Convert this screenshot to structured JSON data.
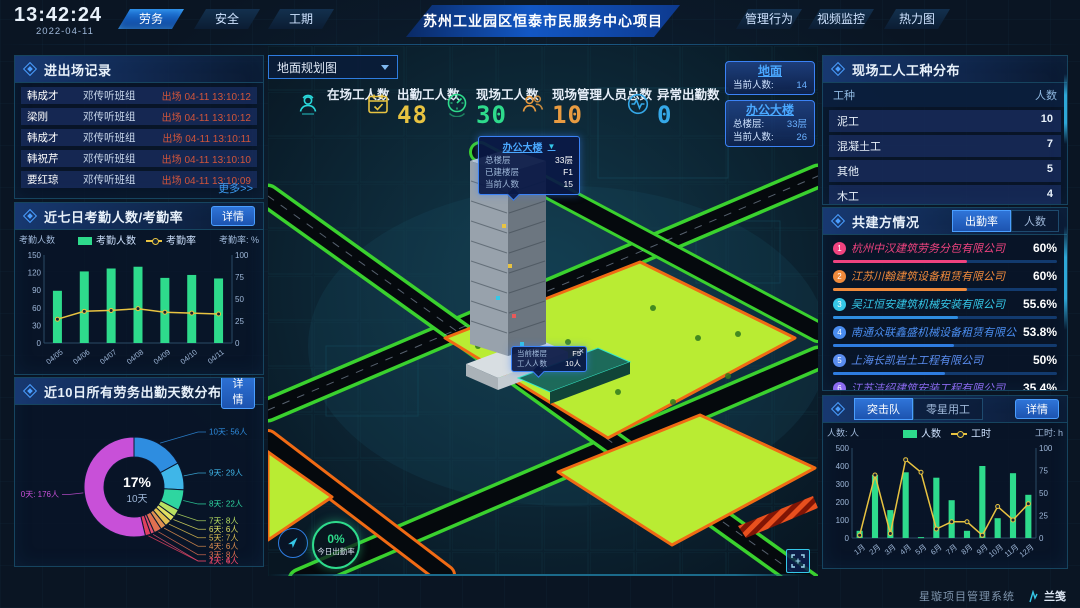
{
  "header": {
    "time": "13:42:24",
    "date": "2022-04-11",
    "left_tabs": [
      {
        "label": "劳务",
        "active": true
      },
      {
        "label": "安全",
        "active": false
      },
      {
        "label": "工期",
        "active": false
      }
    ],
    "title": "苏州工业园区恒泰市民服务中心项目",
    "right_tabs": [
      {
        "label": "管理行为",
        "active": false
      },
      {
        "label": "视频监控",
        "active": false
      },
      {
        "label": "热力图",
        "active": false
      }
    ]
  },
  "entry_exit": {
    "title": "进出场记录",
    "more_label": "更多>>",
    "rows": [
      {
        "name": "韩成才",
        "group": "邓传听班组",
        "event": "出场 04-11 13:10:12"
      },
      {
        "name": "梁刚",
        "group": "邓传听班组",
        "event": "出场 04-11 13:10:12"
      },
      {
        "name": "韩成才",
        "group": "邓传听班组",
        "event": "出场 04-11 13:10:11"
      },
      {
        "name": "韩祝芹",
        "group": "邓传听班组",
        "event": "出场 04-11 13:10:10"
      },
      {
        "name": "要红琼",
        "group": "邓传听班组",
        "event": "出场 04-11 13:10:09"
      }
    ]
  },
  "attendance7": {
    "title": "近七日考勤人数/考勤率",
    "detail_label": "详情"
  },
  "distribution10": {
    "title": "近10日所有劳务出勤天数分布",
    "detail_label": "详情"
  },
  "map": {
    "view_select": "地面规划图",
    "stats": [
      {
        "label": "在场工人数",
        "value": "",
        "color": "#29d8db",
        "icon": "worker-icon"
      },
      {
        "label": "出勤工人数",
        "value": "48",
        "color": "#e8c341",
        "icon": "calendar-check-icon"
      },
      {
        "label": "现场工人数",
        "value": "30",
        "color": "#2edb8c",
        "icon": "gauge-icon"
      },
      {
        "label": "现场管理人员总数",
        "value": "10",
        "color": "#e89b41",
        "icon": "people-icon"
      },
      {
        "label": "异常出勤数",
        "value": "0",
        "color": "#35a8e8",
        "icon": "pulse-icon"
      }
    ],
    "building_cards": [
      {
        "name": "地面",
        "fields": [
          {
            "label": "当前人数:",
            "value": "14"
          }
        ]
      },
      {
        "name": "办公大楼",
        "fields": [
          {
            "label": "总楼层:",
            "value": "33层"
          },
          {
            "label": "当前人数:",
            "value": "26"
          }
        ]
      }
    ],
    "tooltip_building": {
      "title": "办公大楼",
      "caret": "▼",
      "rows": [
        {
          "label": "总楼层",
          "value": "33层"
        },
        {
          "label": "已建楼层",
          "value": "F1"
        },
        {
          "label": "当前人数",
          "value": "15"
        }
      ]
    },
    "tooltip_floor": {
      "close": "×",
      "rows": [
        {
          "label": "当前楼层",
          "value": "F5"
        },
        {
          "label": "工人人数",
          "value": "10人"
        }
      ]
    },
    "attendance_ring": {
      "pct": "0%",
      "label": "今日出勤率"
    }
  },
  "worker_types": {
    "title": "现场工人工种分布",
    "headers": {
      "col1": "工种",
      "col2": "人数"
    },
    "rows": [
      {
        "type": "泥工",
        "count": "10"
      },
      {
        "type": "混凝土工",
        "count": "7"
      },
      {
        "type": "其他",
        "count": "5"
      },
      {
        "type": "木工",
        "count": "4"
      },
      {
        "type": "塔司",
        "count": "4"
      }
    ]
  },
  "partners": {
    "title": "共建方情况",
    "tabs": [
      {
        "label": "出勤率",
        "active": true
      },
      {
        "label": "人数",
        "active": false
      }
    ],
    "rows": [
      {
        "rank": "1",
        "name": "杭州中汉建筑劳务分包有限公司",
        "pct": "60%",
        "value": 60,
        "color": "#f0437f",
        "bar_color": "#f0437f"
      },
      {
        "rank": "2",
        "name": "江苏川翰建筑设备租赁有限公司",
        "pct": "60%",
        "value": 60,
        "color": "#f08a3b",
        "bar_color": "#f08a3b"
      },
      {
        "rank": "3",
        "name": "吴江恒安建筑机械安装有限公司",
        "pct": "55.6%",
        "value": 55.6,
        "color": "#35c8e8",
        "bar_color": "#2e8de0"
      },
      {
        "rank": "4",
        "name": "南通众联鑫盛机械设备租赁有限公司",
        "pct": "53.8%",
        "value": 53.8,
        "color": "#4a8df0",
        "bar_color": "#2e7ce0"
      },
      {
        "rank": "5",
        "name": "上海长凯岩土工程有限公司",
        "pct": "50%",
        "value": 50,
        "color": "#5a8df0",
        "bar_color": "#2e7ce0"
      },
      {
        "rank": "6",
        "name": "江苏洁绍建筑安装工程有限公司",
        "pct": "35.4%",
        "value": 35.4,
        "color": "#8b6af0",
        "bar_color": "#6a5af0"
      }
    ]
  },
  "squad": {
    "tabs": [
      {
        "label": "突击队",
        "active": true
      },
      {
        "label": "零星用工",
        "active": false
      }
    ],
    "detail_label": "详情"
  },
  "footer": {
    "system_name": "星璇项目管理系统",
    "logo_text": "兰笺"
  },
  "chart_data": [
    {
      "id": "attendance7",
      "type": "bar",
      "categories": [
        "04/05",
        "04/06",
        "04/07",
        "04/08",
        "04/09",
        "04/10",
        "04/11"
      ],
      "series": [
        {
          "name": "考勤人数",
          "type": "bar",
          "values": [
            89,
            122,
            127,
            130,
            111,
            116,
            110
          ],
          "color": "#2edb8c"
        },
        {
          "name": "考勤率",
          "type": "line",
          "values": [
            27,
            36,
            37,
            39,
            35,
            34,
            33
          ],
          "color": "#e8c341",
          "yaxis": "right"
        }
      ],
      "ylabel_left": "考勤人数",
      "ylabel_right": "考勤率: %",
      "ylim_left": [
        0,
        150
      ],
      "ylim_right": [
        0,
        100
      ],
      "yticks_left": [
        0,
        30,
        60,
        90,
        120,
        150
      ],
      "yticks_right": [
        0,
        25,
        50,
        75,
        100
      ],
      "grid": false,
      "legend_position": "top"
    },
    {
      "id": "distribution10",
      "type": "pie",
      "title": "近10日所有劳务出勤天数分布",
      "center_value": "17%",
      "center_label": "10天",
      "slices": [
        {
          "label": "10天",
          "count": "56人",
          "value": 56,
          "color": "#2e8de0"
        },
        {
          "label": "9天",
          "count": "29人",
          "value": 29,
          "color": "#3fb6e8"
        },
        {
          "label": "8天",
          "count": "22人",
          "value": 22,
          "color": "#2ed6a0"
        },
        {
          "label": "7天",
          "count": "8人",
          "value": 8,
          "color": "#b8e062"
        },
        {
          "label": "6天",
          "count": "6人",
          "value": 6,
          "color": "#e0e062"
        },
        {
          "label": "5天",
          "count": "7人",
          "value": 7,
          "color": "#e0c050"
        },
        {
          "label": "4天",
          "count": "6人",
          "value": 6,
          "color": "#e09050"
        },
        {
          "label": "3天",
          "count": "8人",
          "value": 8,
          "color": "#e07050"
        },
        {
          "label": "2天",
          "count": "4人",
          "value": 4,
          "color": "#e05070"
        },
        {
          "label": "1天",
          "count": "6人",
          "value": 6,
          "color": "#e04060"
        },
        {
          "label": "0天",
          "count": "176人",
          "value": 176,
          "color": "#c850d8"
        }
      ]
    },
    {
      "id": "squad",
      "type": "bar",
      "categories": [
        "1月",
        "2月",
        "3月",
        "4月",
        "5月",
        "6月",
        "7月",
        "8月",
        "9月",
        "10月",
        "11月",
        "12月"
      ],
      "series": [
        {
          "name": "人数",
          "type": "bar",
          "values": [
            40,
            350,
            155,
            365,
            5,
            335,
            210,
            40,
            400,
            110,
            360,
            240
          ],
          "color": "#2edb8c"
        },
        {
          "name": "工时",
          "type": "line",
          "values": [
            3,
            70,
            5,
            87,
            73,
            10,
            18,
            18,
            3,
            35,
            20,
            38
          ],
          "color": "#e8c341",
          "yaxis": "right"
        }
      ],
      "ylabel_left": "人数: 人",
      "ylabel_right": "工时: h",
      "ylim_left": [
        0,
        500
      ],
      "ylim_right": [
        0,
        100
      ],
      "yticks_left": [
        0,
        100,
        200,
        300,
        400,
        500
      ],
      "yticks_right": [
        0,
        25,
        50,
        75,
        100
      ],
      "grid": false,
      "legend_position": "top"
    }
  ]
}
